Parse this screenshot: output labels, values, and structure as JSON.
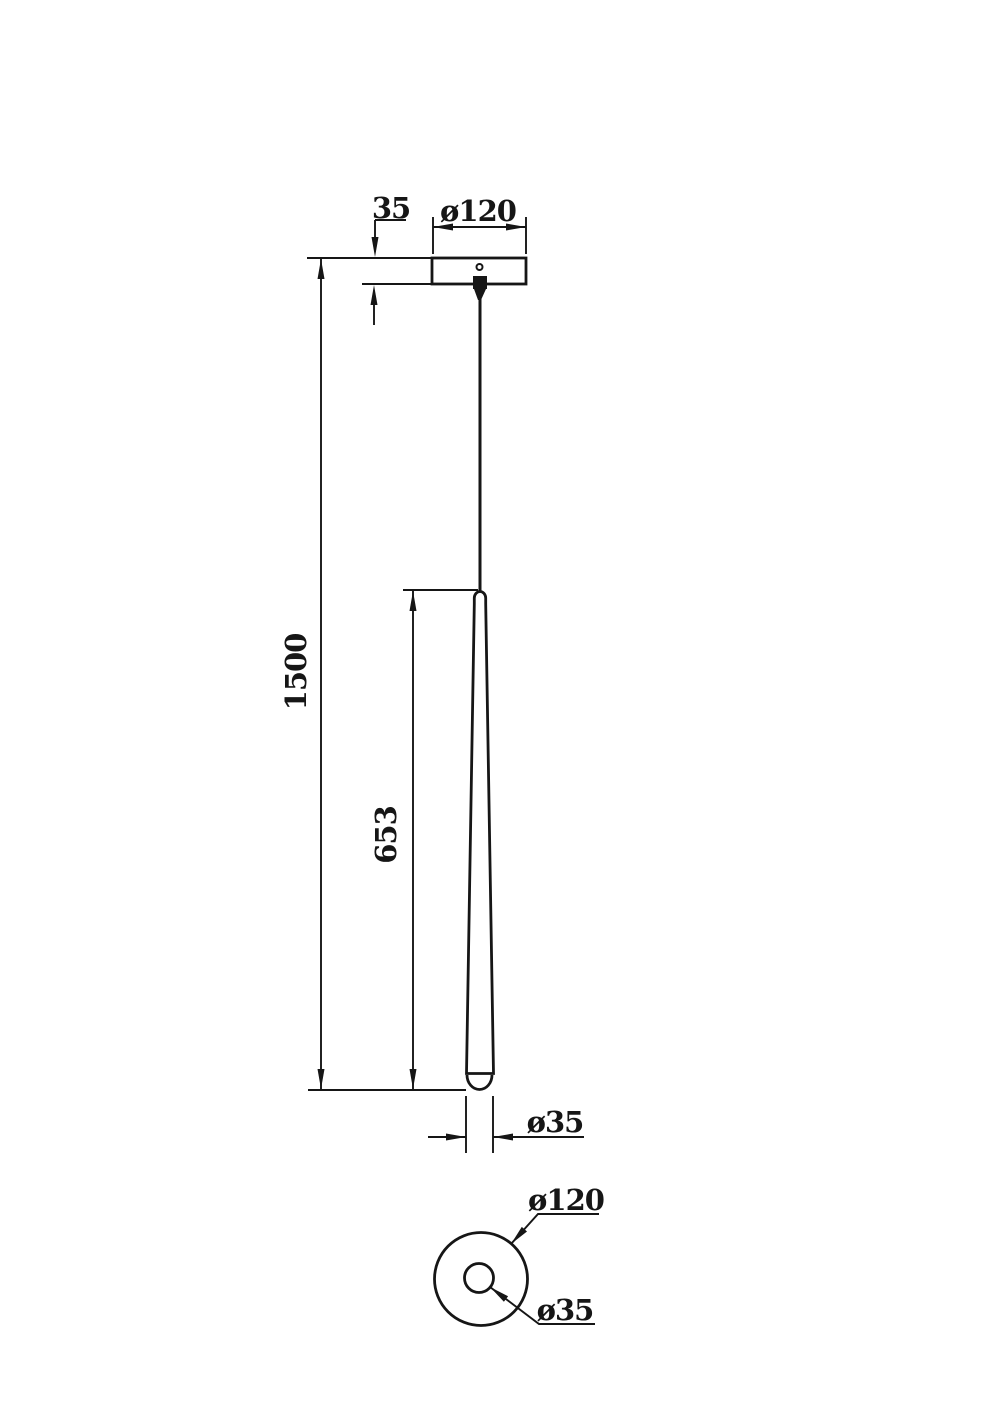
{
  "page": {
    "background_color": "#ffffff",
    "line_color": "#161616",
    "description": "Technical dimension drawing of a cone pendant lamp, front elevation and bottom view"
  },
  "front_view": {
    "canopy_thickness_label": "35",
    "canopy_diameter_label": "ø120",
    "overall_height_label": "1500",
    "shade_length_label": "653",
    "shade_diameter_label": "ø35"
  },
  "bottom_view": {
    "outer_diameter_label": "ø120",
    "hole_diameter_label": "ø35"
  }
}
